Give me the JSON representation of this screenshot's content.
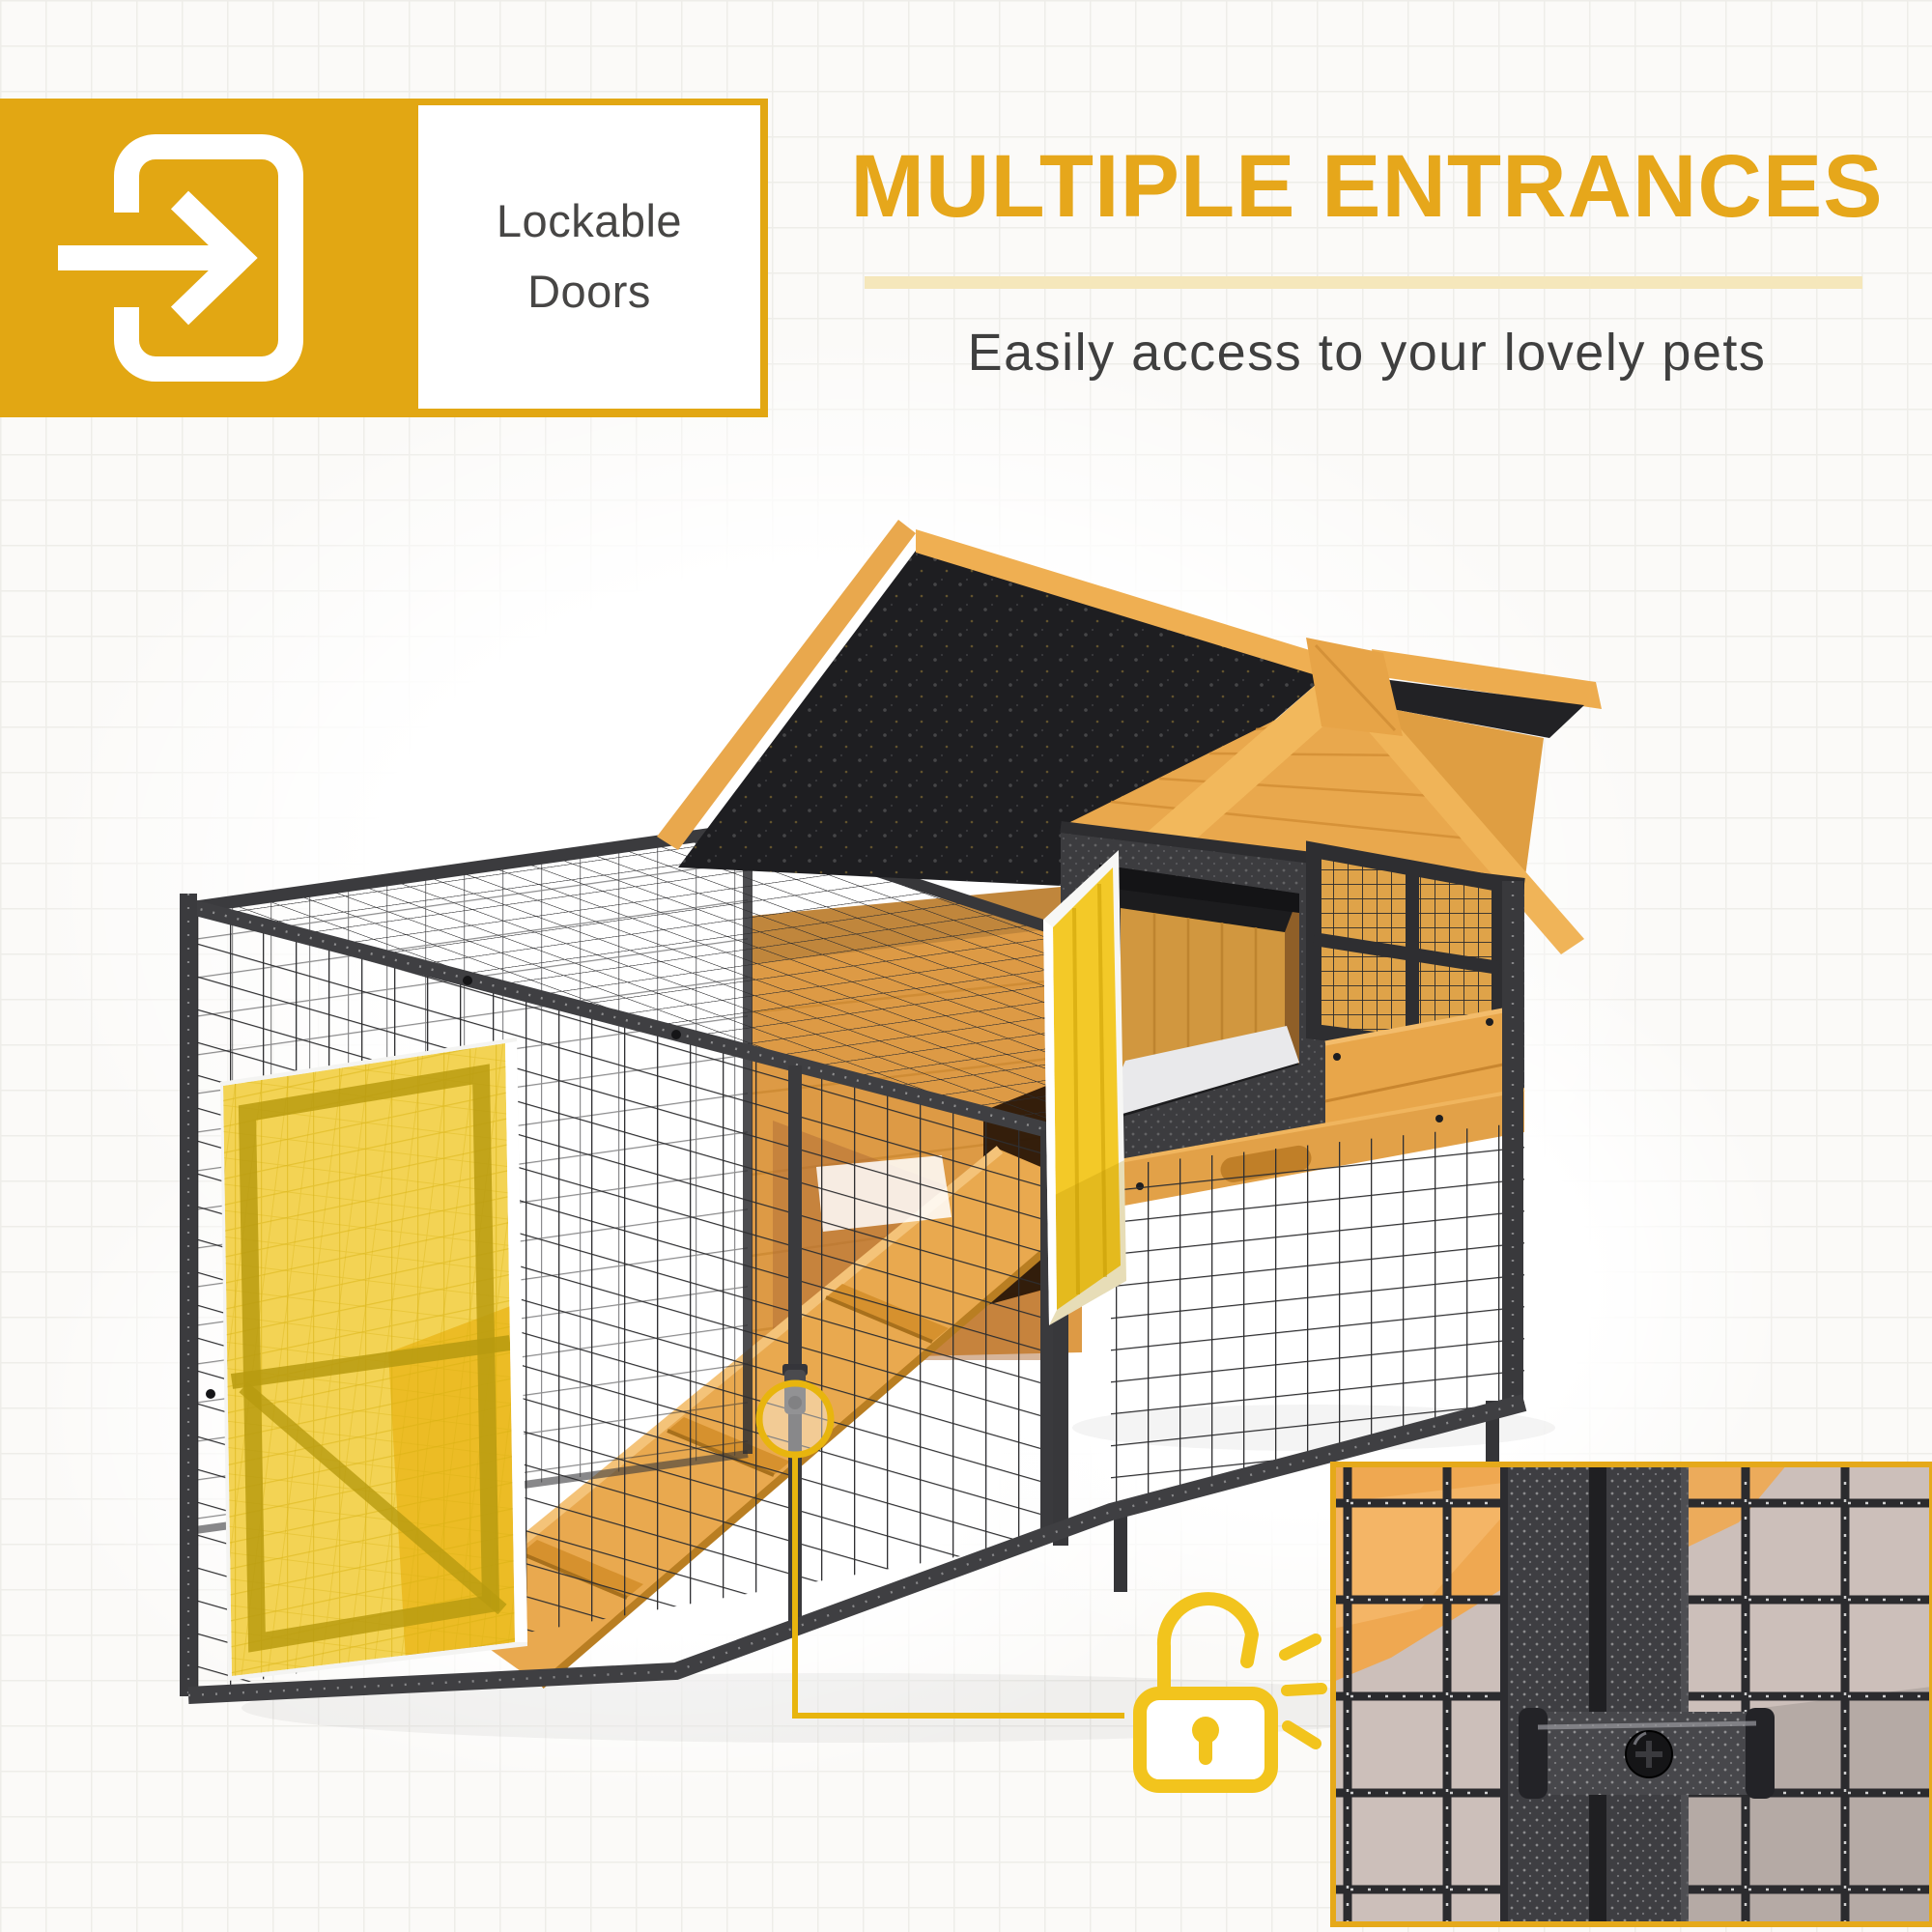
{
  "badge": {
    "label": "Lockable Doors"
  },
  "header": {
    "title": "MULTIPLE ENTRANCES",
    "subtitle": "Easily access to your lovely pets"
  },
  "colors": {
    "accent": "#E2A713",
    "heading": "#E6A71B",
    "pale-bar": "#F5E7BB",
    "text-dark": "#3F3F3F",
    "highlight": "#F2C41D",
    "wood": "#E8A64A",
    "roof": "#1E1E21",
    "metal": "#3B3B3E",
    "mesh": "#2E2E30",
    "inset-bg": "#CCBFBA"
  }
}
